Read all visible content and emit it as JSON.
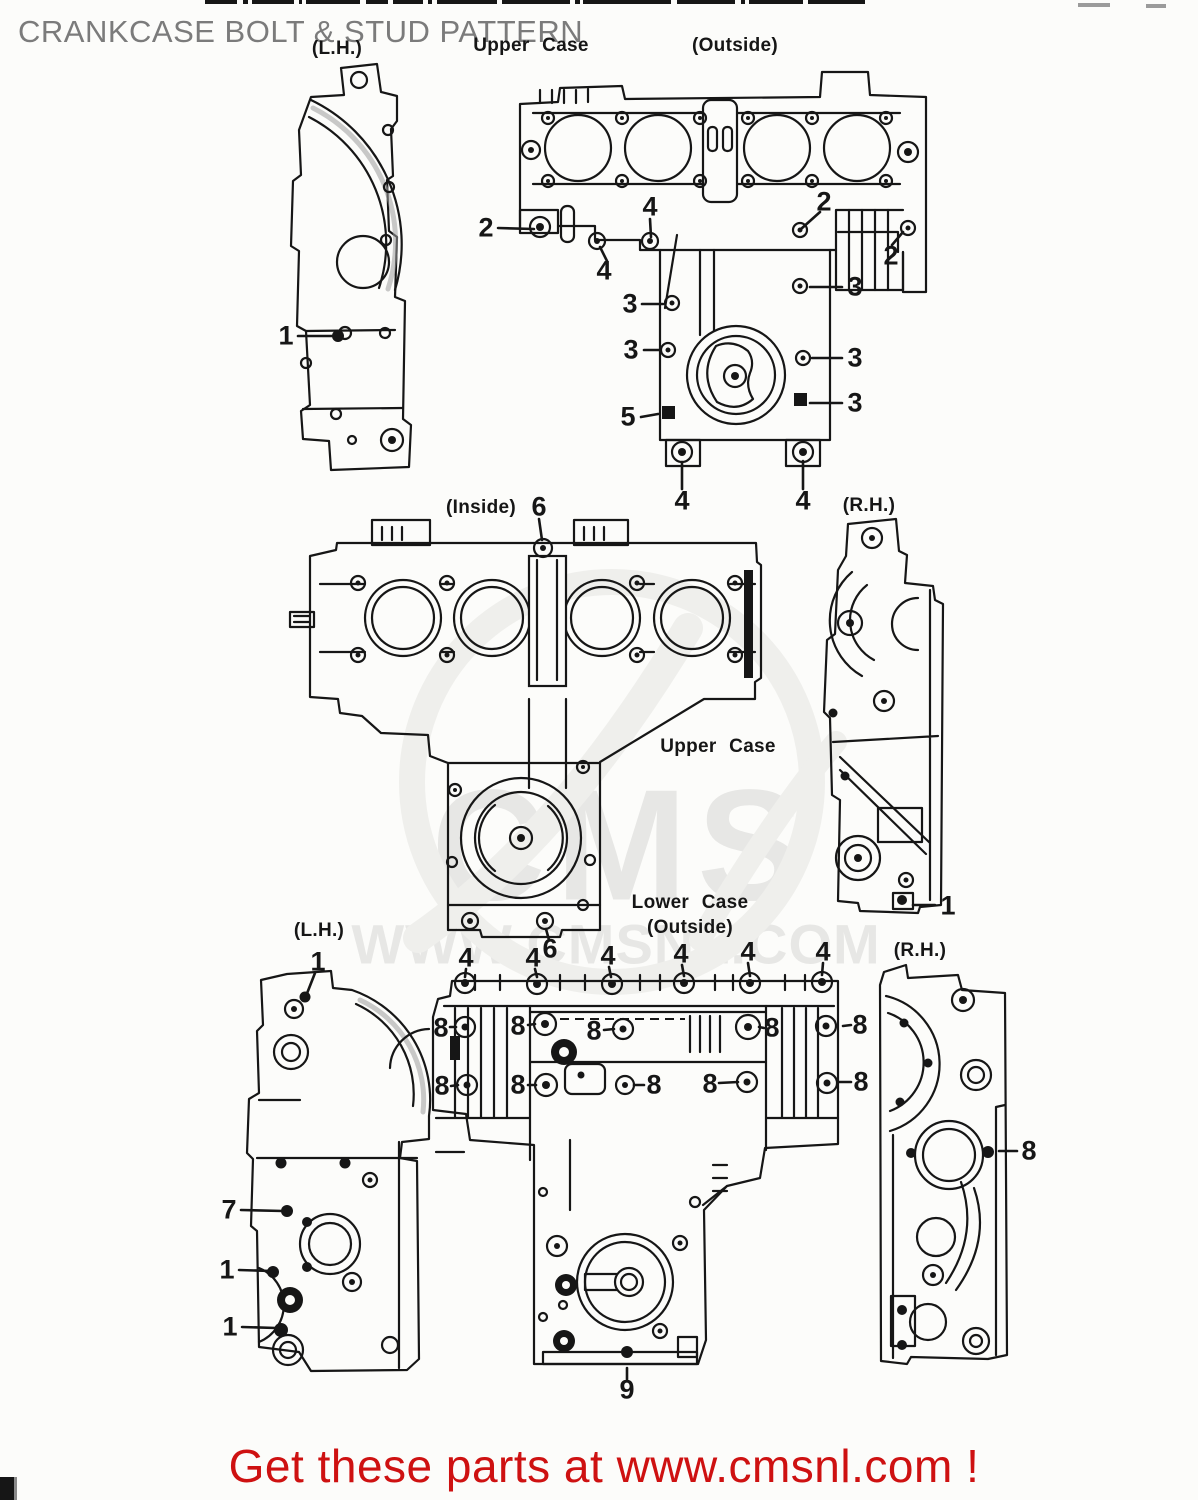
{
  "title": "CRANKCASE BOLT & STUD PATTERN",
  "watermark": {
    "logo_text": "CMS",
    "site_text": "WWW.CMSNL.COM"
  },
  "footer": {
    "text": "Get these parts at www.cmsnl.com !"
  },
  "colors": {
    "ink": "#161616",
    "paper": "#fcfcfa",
    "title_gray": "#7b7b7b",
    "footer_red": "#ce1111",
    "watermark_gray": "#e7e7e5",
    "swoosh_gray": "#efefec"
  },
  "diagram_labels": [
    {
      "text": "(L.H.)",
      "x": 337,
      "y": 49
    },
    {
      "text": "Upper Case",
      "x": 531,
      "y": 46
    },
    {
      "text": "(Outside)",
      "x": 735,
      "y": 46
    },
    {
      "text": "(Inside)",
      "x": 481,
      "y": 508
    },
    {
      "text": "(R.H.)",
      "x": 869,
      "y": 506
    },
    {
      "text": "Upper Case",
      "x": 718,
      "y": 747
    },
    {
      "text": "Lower Case",
      "x": 690,
      "y": 903
    },
    {
      "text": "(Outside)",
      "x": 690,
      "y": 928
    },
    {
      "text": "(L.H.)",
      "x": 319,
      "y": 931
    },
    {
      "text": "(R.H.)",
      "x": 920,
      "y": 951
    }
  ],
  "callouts": [
    {
      "n": "1",
      "x": 286,
      "y": 336
    },
    {
      "n": "2",
      "x": 486,
      "y": 228
    },
    {
      "n": "4",
      "x": 650,
      "y": 207
    },
    {
      "n": "4",
      "x": 604,
      "y": 271
    },
    {
      "n": "2",
      "x": 824,
      "y": 202
    },
    {
      "n": "2",
      "x": 891,
      "y": 256
    },
    {
      "n": "3",
      "x": 630,
      "y": 304
    },
    {
      "n": "3",
      "x": 855,
      "y": 287
    },
    {
      "n": "3",
      "x": 631,
      "y": 350
    },
    {
      "n": "3",
      "x": 855,
      "y": 358
    },
    {
      "n": "3",
      "x": 855,
      "y": 403
    },
    {
      "n": "5",
      "x": 628,
      "y": 417
    },
    {
      "n": "4",
      "x": 682,
      "y": 501
    },
    {
      "n": "4",
      "x": 803,
      "y": 501
    },
    {
      "n": "6",
      "x": 539,
      "y": 507
    },
    {
      "n": "1",
      "x": 948,
      "y": 906
    },
    {
      "n": "1",
      "x": 318,
      "y": 962
    },
    {
      "n": "4",
      "x": 466,
      "y": 958
    },
    {
      "n": "4",
      "x": 533,
      "y": 958
    },
    {
      "n": "6",
      "x": 550,
      "y": 949
    },
    {
      "n": "4",
      "x": 608,
      "y": 956
    },
    {
      "n": "4",
      "x": 681,
      "y": 954
    },
    {
      "n": "4",
      "x": 748,
      "y": 952
    },
    {
      "n": "4",
      "x": 823,
      "y": 952
    },
    {
      "n": "8",
      "x": 441,
      "y": 1028
    },
    {
      "n": "8",
      "x": 518,
      "y": 1026
    },
    {
      "n": "8",
      "x": 594,
      "y": 1031
    },
    {
      "n": "8",
      "x": 772,
      "y": 1028
    },
    {
      "n": "8",
      "x": 860,
      "y": 1025
    },
    {
      "n": "8",
      "x": 442,
      "y": 1086
    },
    {
      "n": "8",
      "x": 518,
      "y": 1085
    },
    {
      "n": "8",
      "x": 654,
      "y": 1085
    },
    {
      "n": "8",
      "x": 710,
      "y": 1084
    },
    {
      "n": "8",
      "x": 861,
      "y": 1082
    },
    {
      "n": "8",
      "x": 1029,
      "y": 1151
    },
    {
      "n": "7",
      "x": 229,
      "y": 1210
    },
    {
      "n": "1",
      "x": 227,
      "y": 1270
    },
    {
      "n": "1",
      "x": 230,
      "y": 1327
    },
    {
      "n": "9",
      "x": 627,
      "y": 1390
    }
  ]
}
